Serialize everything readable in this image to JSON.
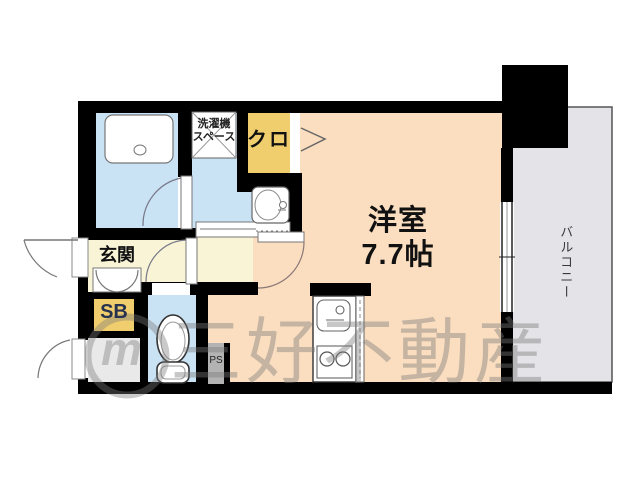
{
  "floorplan": {
    "rooms": {
      "main_room": {
        "name": "洋室",
        "size": "7.7帖"
      },
      "balcony": {
        "name": "バルコニー"
      },
      "entrance": {
        "name": "玄関"
      },
      "shoe_box": {
        "name": "SB"
      },
      "closet": {
        "name": "クロ"
      },
      "washer_space": {
        "line1": "洗濯機",
        "line2": "スペース"
      },
      "pipe_space": {
        "name": "PS"
      }
    },
    "watermark": {
      "logo_letter": "m",
      "company": "三好不動産"
    },
    "colors": {
      "wall": "#000000",
      "main_room_fill": "#fbdec0",
      "wet_area_fill": "#c9e2f4",
      "hall_fill": "#f9f4d6",
      "closet_fill": "#f1ce6d",
      "balcony_fill": "#e4e3e8",
      "storage_fill": "#e9e9e9",
      "pipe_space_fill": "#b3b3b3",
      "watermark_gray": "#7a7a7a"
    }
  }
}
